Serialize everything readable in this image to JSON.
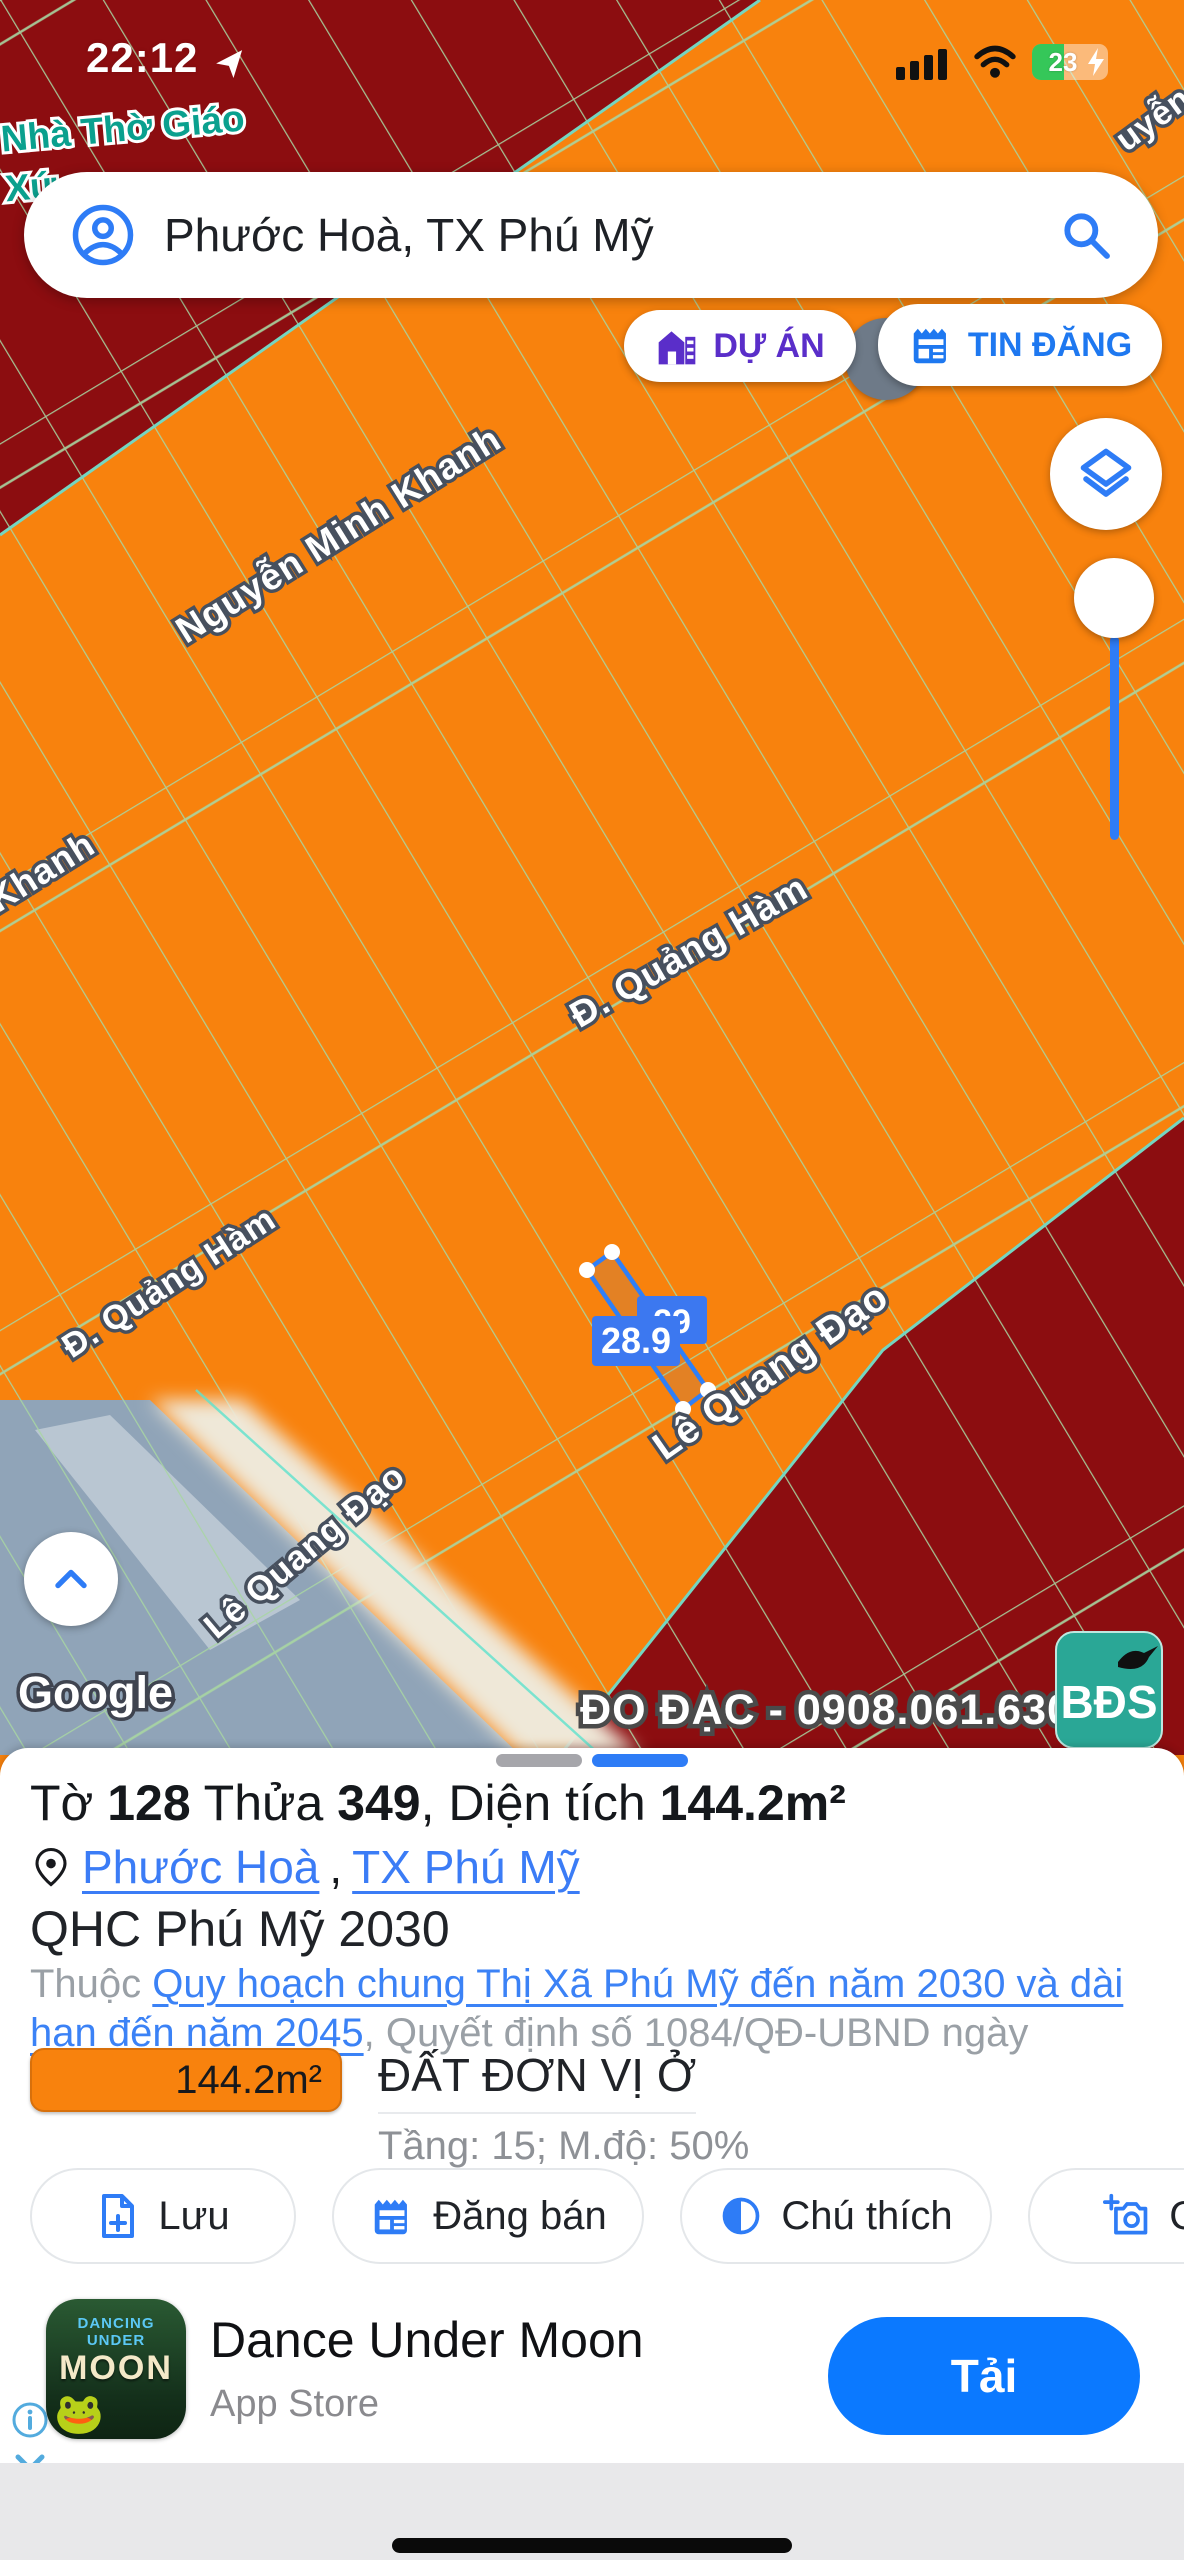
{
  "status_bar": {
    "time": "22:12",
    "battery_percent": "23"
  },
  "search": {
    "query": "Phước Hoà, TX Phú Mỹ"
  },
  "map_buttons": {
    "du_an": "DỰ ÁN",
    "tin_dang": "TIN ĐĂNG"
  },
  "map": {
    "labels": {
      "street_nguyen_minh_khanh": "Nguyễn Minh Khanh",
      "street_khanh_fragment": "Khanh",
      "street_quang_ham": "Đ. Quảng Hàm",
      "street_quang_ham_2": "Đ. Quảng Hàm",
      "street_le_quang_dao": "Lê Quang Đạo",
      "street_le_quang_dao_2": "Lê Quang Đạo",
      "street_fragment_top_right": "uyễn",
      "poi_line1": "Nhà Thờ Giáo",
      "poi_line2": "Xứ"
    },
    "selected_parcel": {
      "measure_front": "28.9",
      "measure_back": "29"
    },
    "watermark": "ĐO ĐẠC - 0908.061.630",
    "bds_logo": "BĐS",
    "google_logo": "Google"
  },
  "sheet": {
    "title": {
      "p1": "Tờ ",
      "b1": "128",
      "p2": " Thửa ",
      "b2": "349",
      "p3": ", Diện tích ",
      "b3": "144.2m²"
    },
    "location": {
      "ward": "Phước Hoà",
      "separator": ", ",
      "town": "TX Phú Mỹ"
    },
    "plan_name": "QHC Phú Mỹ 2030",
    "belong_prefix": "Thuộc ",
    "plan_link": "Quy hoạch chung Thị Xã Phú Mỹ đến năm 2030 và dài hạn đến năm 2045",
    "decision_suffix": ", Quyết định số 1084/QĐ-UBND ngày 24/04/2024",
    "legend": {
      "area": "144.2m²",
      "land_type": "ĐẤT ĐƠN VỊ Ở",
      "params": "Tầng: 15; M.độ: 50%",
      "color": "#F8820D"
    },
    "actions": [
      {
        "label": "Lưu"
      },
      {
        "label": "Đăng bán"
      },
      {
        "label": "Chú thích"
      },
      {
        "label": "Chụ"
      }
    ]
  },
  "ad": {
    "title": "Dance Under Moon",
    "subtitle": "App Store",
    "cta": "Tải",
    "icon_line1": "DANCING UNDER",
    "icon_line2": "MOON"
  },
  "colors": {
    "zone_orange": "#F8820D",
    "zone_outside_maroon": "#8C0D10",
    "unzoned_gray": "#90A4B8",
    "parcel_line_green": "#A8D6A2",
    "accent_blue": "#2E7CF6",
    "link_blue": "#3B7CF6",
    "project_purple": "#5A2EC9",
    "news_blue": "#1E78F0",
    "cta_blue": "#0B79FF",
    "battery_green": "#35C759"
  }
}
